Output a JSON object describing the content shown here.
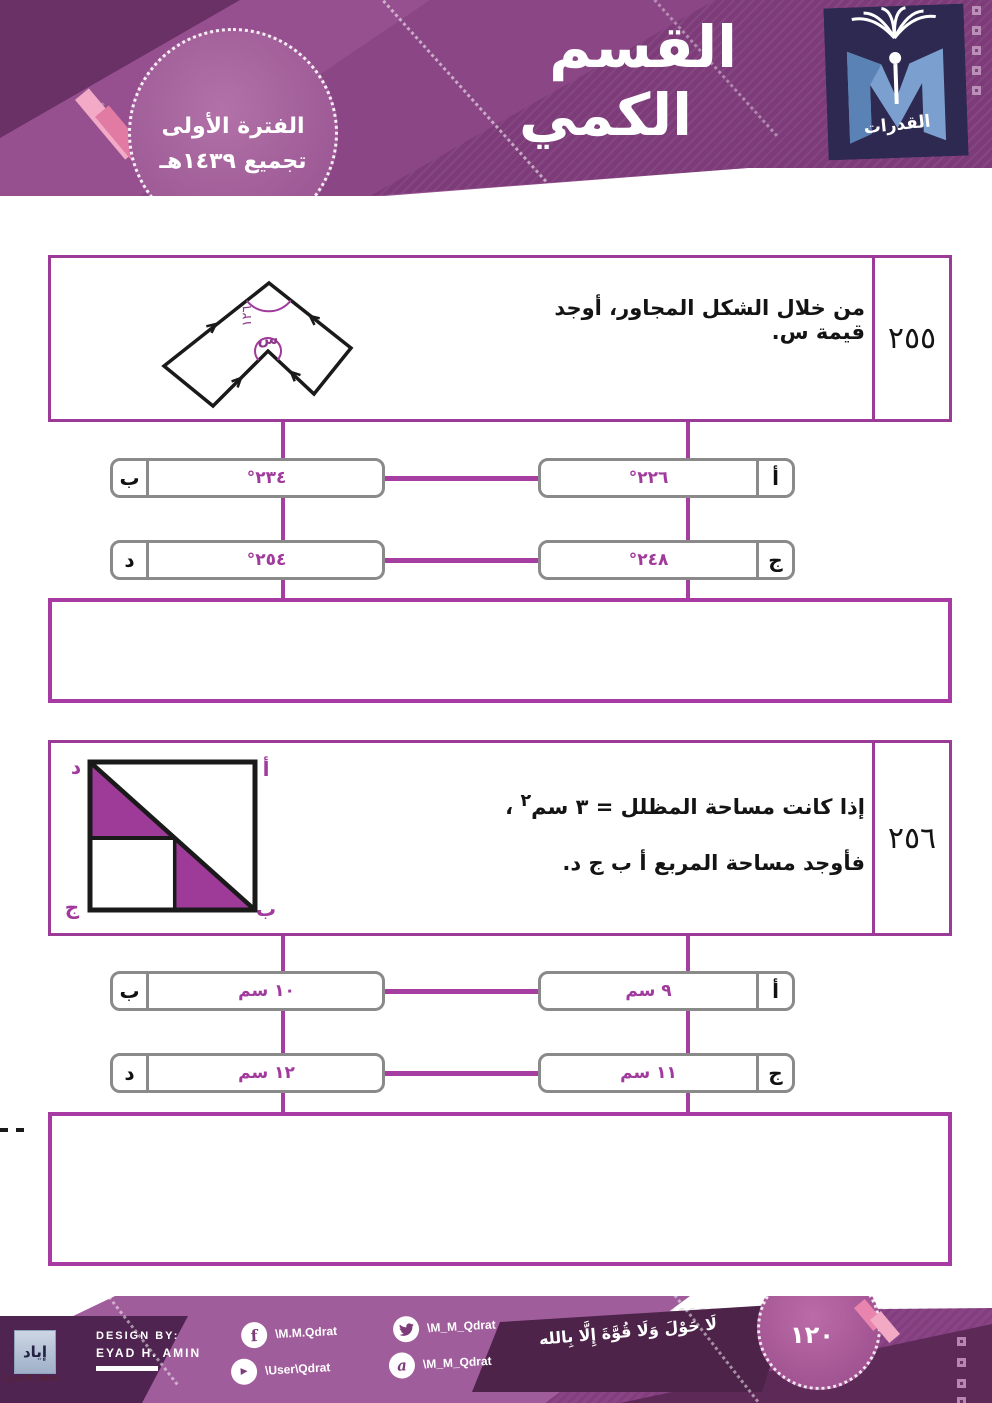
{
  "header": {
    "title_line1": "القسم",
    "title_line2": "الكمي",
    "badge_line1": "الفترة الأولى",
    "badge_line2": "تجميع ١٤٣٩هـ",
    "logo_text": "القدرات"
  },
  "questions": [
    {
      "number": "٢٥٥",
      "text": "من خلال الشكل المجاور، أوجد قيمة س.",
      "figure": {
        "type": "concave-polygon",
        "angle_label": "١٢٦",
        "unknown_label": "س"
      },
      "options": [
        {
          "letter": "أ",
          "value": "٢٢٦°"
        },
        {
          "letter": "ب",
          "value": "٢٣٤°"
        },
        {
          "letter": "ج",
          "value": "٢٤٨°"
        },
        {
          "letter": "د",
          "value": "٢٥٤°"
        }
      ]
    },
    {
      "number": "٢٥٦",
      "text_main": "إذا كانت مساحة المظلل = ٣ سم",
      "text_sup": "٢",
      "text_tail": "،",
      "text_line2": "فأوجد مساحة المربع أ ب ج د.",
      "figure": {
        "type": "square-with-diagonal",
        "corner_top_right": "أ",
        "corner_bottom_right": "ب",
        "corner_bottom_left": "ج",
        "corner_top_left": "د"
      },
      "options": [
        {
          "letter": "أ",
          "value": "٩ سم"
        },
        {
          "letter": "ب",
          "value": "١٠ سم"
        },
        {
          "letter": "ج",
          "value": "١١ سم"
        },
        {
          "letter": "د",
          "value": "١٢ سم"
        }
      ]
    }
  ],
  "footer": {
    "design_by_label": "DESIGN BY:",
    "designer_name": "EYAD H. AMIN",
    "signature_text": "إياد",
    "signature_script": "Eyad H. Amin",
    "calligraphy": "لَا حَوْلَ وَلَا قُوَّةَ إِلَّا بِالله",
    "page_number": "١٢٠",
    "socials": [
      {
        "icon": "facebook-icon",
        "handle": "\\M.M.Qdrat"
      },
      {
        "icon": "twitter-icon",
        "handle": "\\M_M_Qdrat"
      },
      {
        "icon": "youtube-icon",
        "handle": "\\User\\Qdrat"
      },
      {
        "icon": "ask-icon",
        "handle": "\\M_M_Qdrat"
      }
    ]
  }
}
